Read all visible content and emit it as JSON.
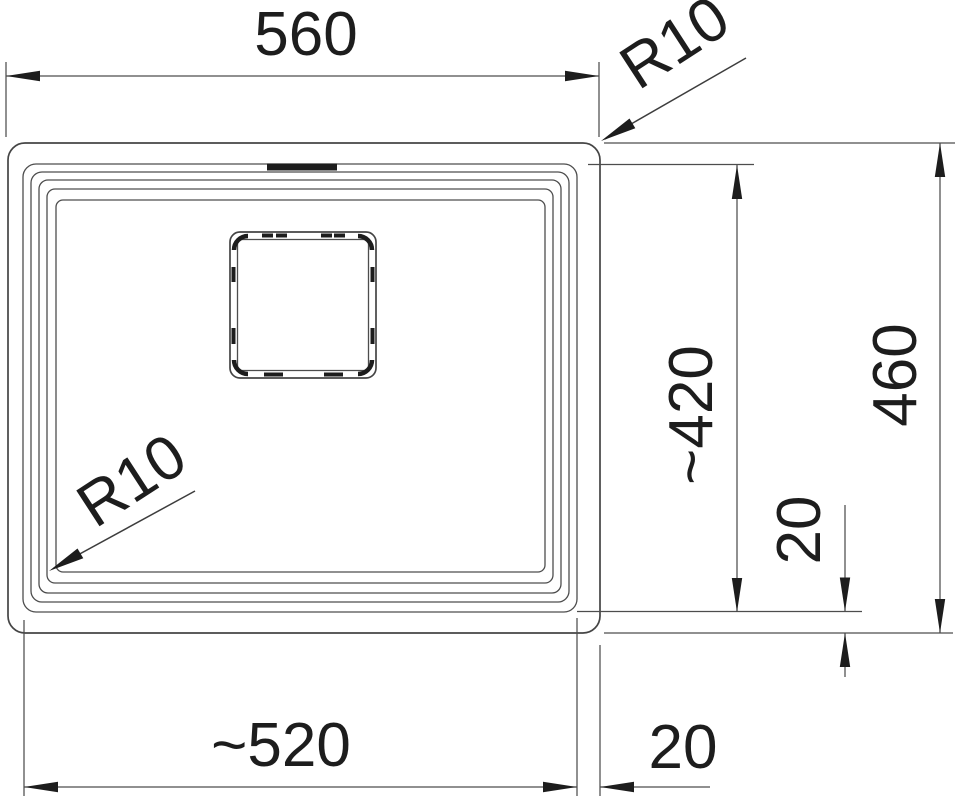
{
  "drawing": {
    "type": "technical-dimension-drawing",
    "subject": "sink-top-view",
    "labels": {
      "outer_width": "560",
      "outer_corner_radius": "R10",
      "basin_height": "~420",
      "outer_height": "460",
      "rim_offset_right": "20",
      "basin_width": "~520",
      "rim_offset_bottom": "20",
      "basin_corner_radius": "R10"
    },
    "colors": {
      "line": "#4d4d4d",
      "ink": "#1d1d1d",
      "background": "#ffffff"
    }
  }
}
